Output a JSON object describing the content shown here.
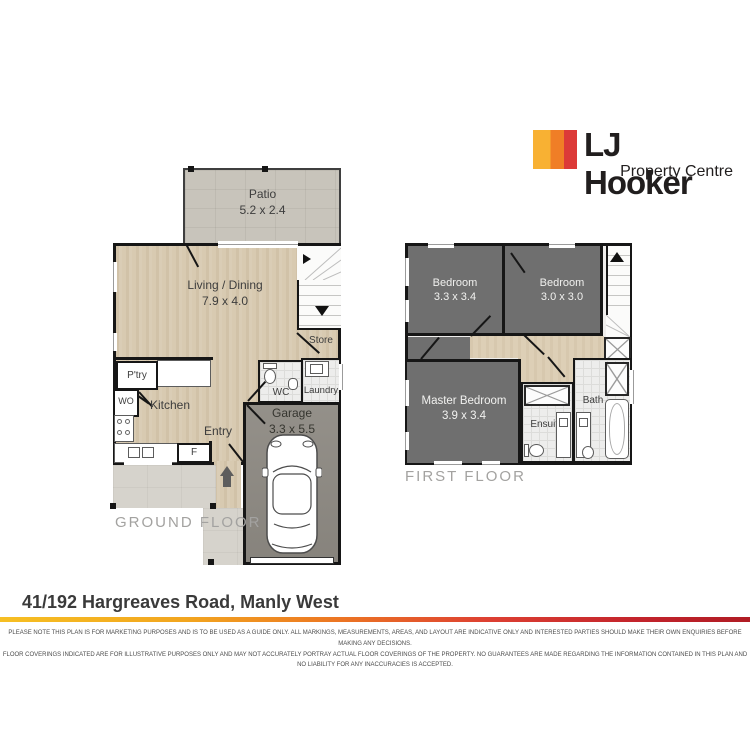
{
  "logo": {
    "brand": "LJ Hooker",
    "tagline": "Property Centre"
  },
  "plans": {
    "ground": {
      "title": "GROUND FLOOR",
      "patio": {
        "name": "Patio",
        "dims": "5.2 x 2.4"
      },
      "living": {
        "name": "Living / Dining",
        "dims": "7.9 x 4.0"
      },
      "store": {
        "name": "Store"
      },
      "kitchen": {
        "name": "Kitchen"
      },
      "pantry": {
        "name": "P'try"
      },
      "wall_oven": {
        "name": "WO"
      },
      "fridge": {
        "name": "F"
      },
      "entry": {
        "name": "Entry"
      },
      "wc": {
        "name": "WC"
      },
      "laundry": {
        "name": "Laundry"
      },
      "garage": {
        "name": "Garage",
        "dims": "3.3 x 5.5"
      }
    },
    "first": {
      "title": "FIRST FLOOR",
      "bedroom2": {
        "name": "Bedroom",
        "dims": "3.3 x 3.4"
      },
      "bedroom3": {
        "name": "Bedroom",
        "dims": "3.0 x 3.0"
      },
      "master": {
        "name": "Master Bedroom",
        "dims": "3.9 x 3.4"
      },
      "ensuite": {
        "name": "Ensuite"
      },
      "bath": {
        "name": "Bath"
      }
    }
  },
  "address": "41/192 Hargreaves Road, Manly West",
  "disclaimer": {
    "line1": "PLEASE NOTE THIS PLAN IS FOR MARKETING PURPOSES AND IS TO BE USED AS A GUIDE ONLY.  ALL MARKINGS, MEASUREMENTS, AREAS, AND LAYOUT ARE INDICATIVE ONLY AND INTERESTED PARTIES SHOULD MAKE THEIR OWN ENQUIRIES BEFORE MAKING ANY DECISIONS.",
    "line2": "FLOOR COVERINGS INDICATED ARE FOR ILLUSTRATIVE PURPOSES ONLY AND MAY NOT ACCURATELY PORTRAY ACTUAL FLOOR COVERINGS OF THE PROPERTY.  NO GUARANTEES ARE MADE REGARDING THE INFORMATION CONTAINED IN THIS PLAN AND NO LIABILITY FOR  ANY INACCURACIES IS ACCEPTED."
  },
  "colors": {
    "brand_yellow": "#F8B133",
    "brand_orange": "#F07E26",
    "brand_red": "#DC3A38",
    "floor_timber": "#D8CAB1",
    "floor_carpet": "#6F6F6F",
    "floor_patio": "#C8C4BB",
    "floor_garage": "#8E8A83"
  }
}
